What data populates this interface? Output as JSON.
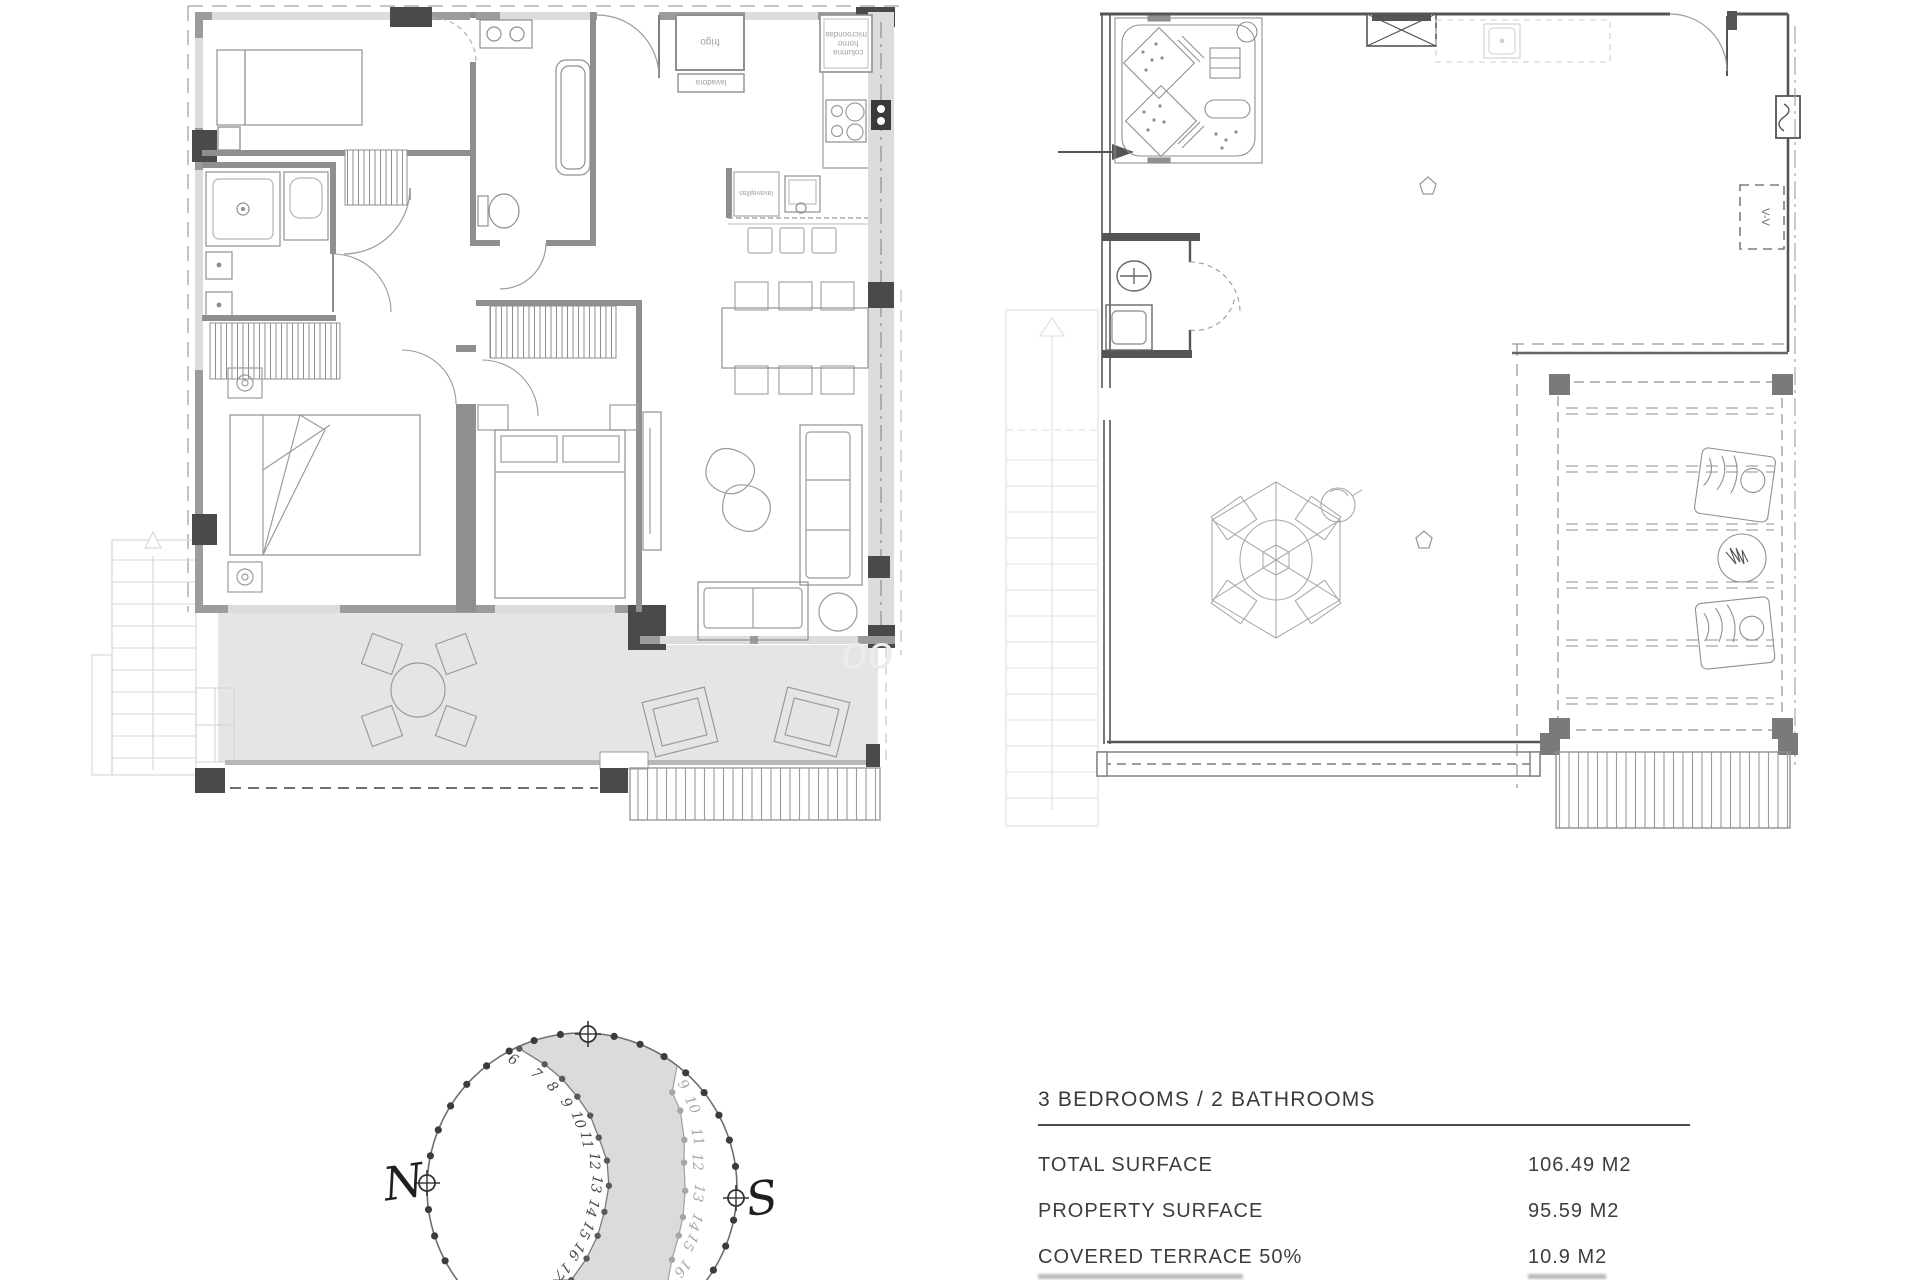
{
  "spec_table": {
    "title": "3 BEDROOMS / 2 BATHROOMS",
    "rows": [
      {
        "label": "TOTAL SURFACE",
        "value": "106.49 M2"
      },
      {
        "label": "PROPERTY SURFACE",
        "value": "95.59 M2"
      },
      {
        "label": "COVERED TERRACE 50%",
        "value": "10.9 M2"
      }
    ]
  },
  "compass": {
    "north": "N",
    "south": "S",
    "inner_arc_hours": [
      "6",
      "7",
      "8",
      "9",
      "10",
      "11",
      "12",
      "13",
      "14",
      "15",
      "16",
      "17"
    ],
    "outer_arc_hours": [
      "9",
      "10",
      "11",
      "12",
      "13",
      "14",
      "15",
      "16"
    ]
  },
  "left_plan": {
    "labels": {
      "fridge": "frigo",
      "washer": "lavadora",
      "oven_column_lines": [
        "columna",
        "horno",
        "microondas"
      ],
      "dishwasher": "lavavajillas"
    },
    "watermark": "oo"
  },
  "right_plan": {
    "section_label": "V-V"
  },
  "colors": {
    "wall": "#9c9c9c",
    "wall_dark": "#4a4a4a",
    "window": "#dcdcdc",
    "terrace": "#e4e4e4",
    "plan_line": "#5a5a5a",
    "text": "#3d3d3d"
  }
}
